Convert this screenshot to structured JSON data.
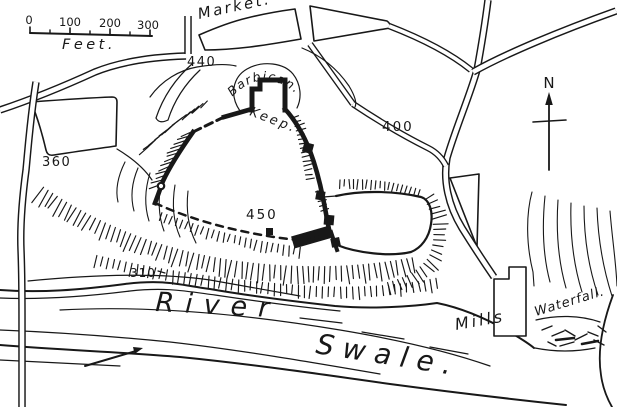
{
  "colors": {
    "ink": "#181818",
    "paper": "#ffffff"
  },
  "scale_bar": {
    "tick_labels": [
      "0",
      "100",
      "200",
      "300"
    ],
    "unit_label": "Feet."
  },
  "compass": {
    "north_label": "N"
  },
  "place_labels": {
    "market": "Market.",
    "barbican": "Barbican.",
    "keep": "Keep.",
    "hall": "Hall.",
    "mills": "Mills",
    "waterfall": "Waterfall.",
    "river_word1": "River",
    "river_word2": "Swale."
  },
  "spot_heights": {
    "northwest": "440",
    "northeast": "400",
    "bailey": "450",
    "west": "360",
    "riverbank": "310"
  }
}
